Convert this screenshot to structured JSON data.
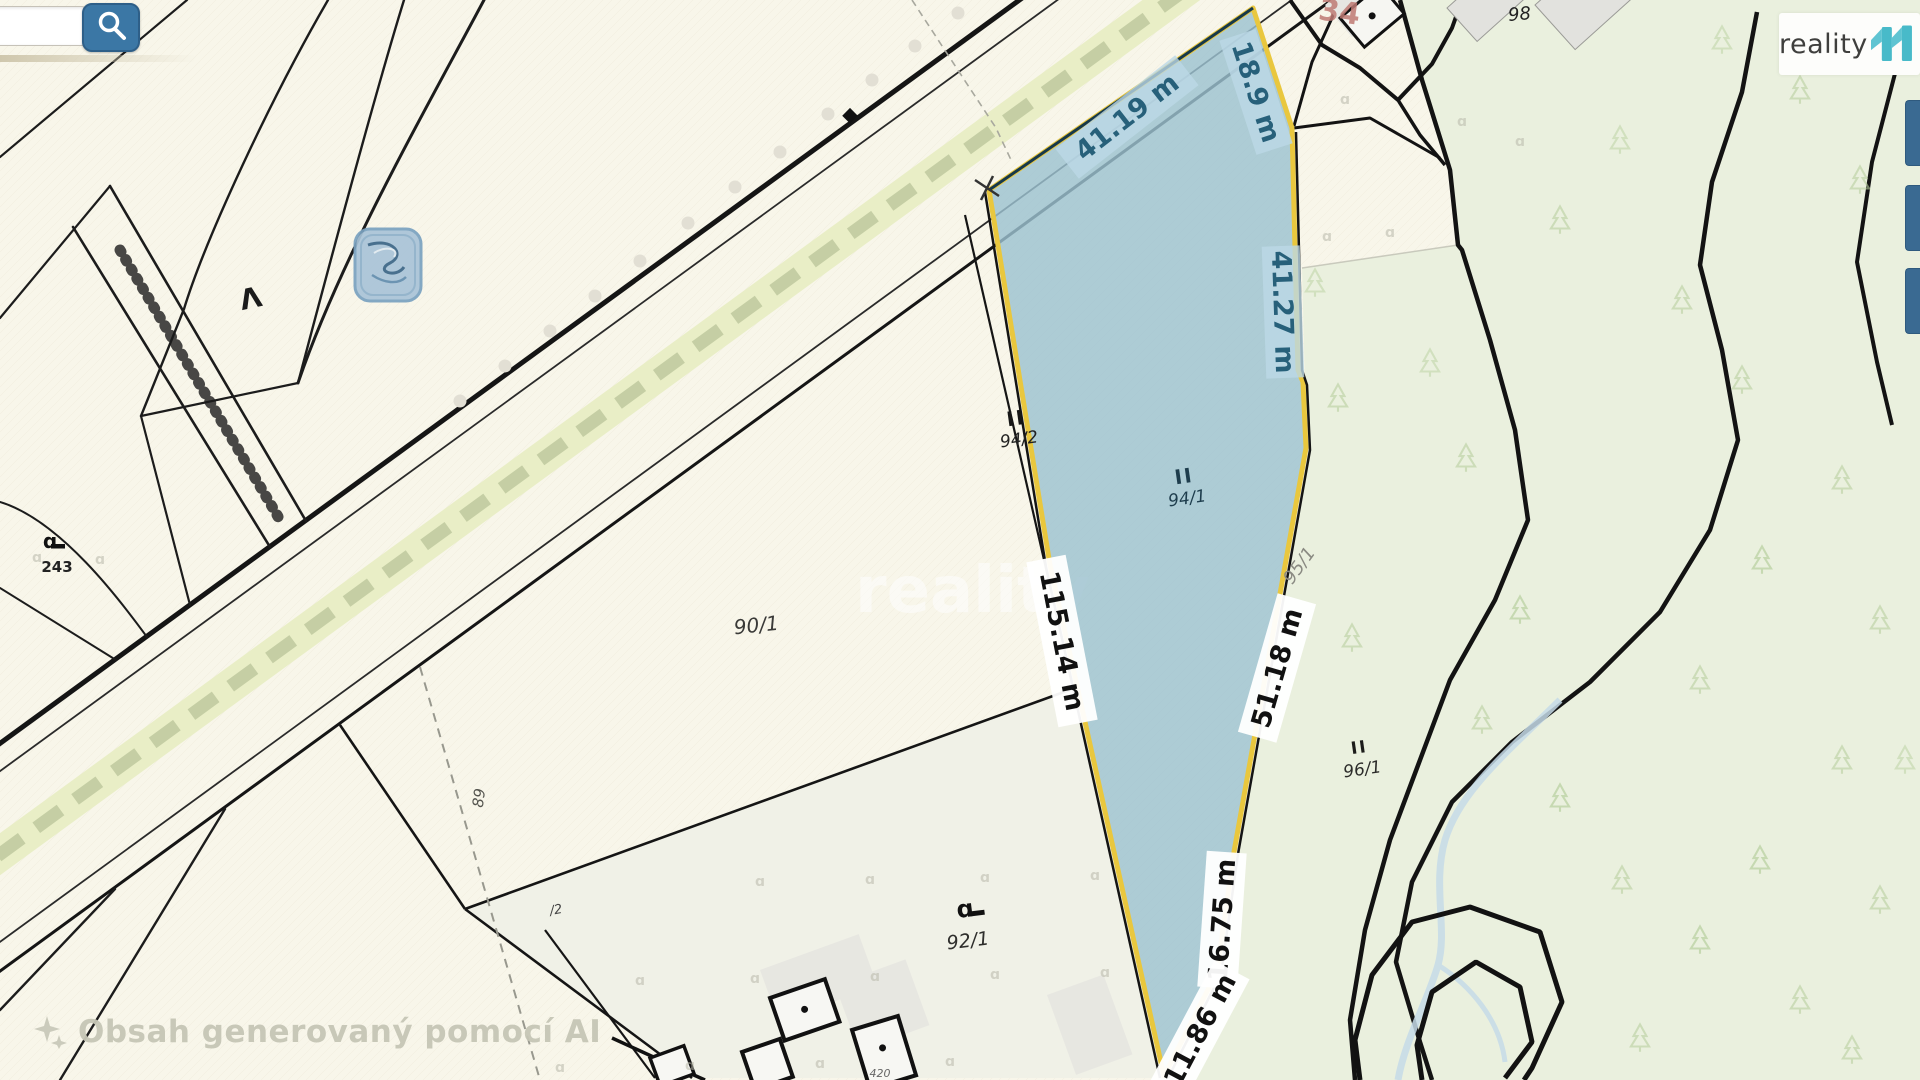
{
  "search": {
    "value": "",
    "placeholder": ""
  },
  "logo": {
    "brand": "reality",
    "number": "11"
  },
  "map": {
    "watermark_text": "reality",
    "ai_notice": "Obsah generovaný pomocí AI",
    "highlighted_parcel": {
      "usage_mark": "II",
      "number": "94/1"
    },
    "measurements": {
      "north": "41.19 m",
      "northeast": "18.9 m",
      "east": "41.27 m",
      "southeast": "51.18 m",
      "west": "115.14 m",
      "south_upper": "16.75 m",
      "south_lower": "11.86 m"
    },
    "parcels": {
      "p94_2": {
        "usage_mark": "II",
        "number": "94/2"
      },
      "p90_1": {
        "number": "90/1"
      },
      "p95_1": {
        "number": "95/1"
      },
      "p96_1": {
        "usage_mark": "II",
        "number": "96/1"
      },
      "p92_1": {
        "number": "92/1"
      },
      "p243": {
        "number": "243"
      },
      "p98": {
        "number": "98"
      },
      "p34": {
        "number": "34"
      },
      "p89": {
        "number": "89"
      },
      "p_2": {
        "number": "/2"
      },
      "p420": {
        "number": "420"
      }
    },
    "symbols": {
      "caret": "Λ",
      "grassland": "ɑ"
    },
    "colors": {
      "parcel_fill": "#9cc2d1",
      "parcel_border": "#e9c73e",
      "measure_text_blue": "#27607a",
      "forest_bg": "#eaf0de",
      "road_band": "#e9eec6",
      "accent_teal": "#48bac9",
      "button_blue": "#3b77a5"
    }
  }
}
